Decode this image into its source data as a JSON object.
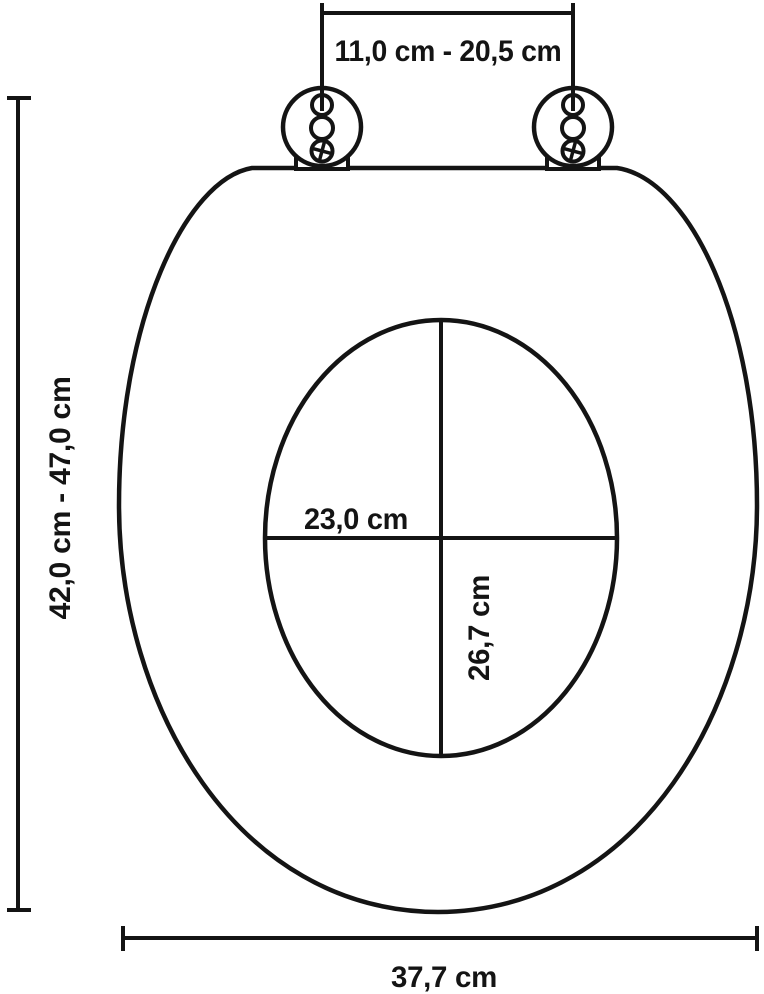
{
  "diagram": {
    "labels": {
      "hinge_spacing": "11,0 cm - 20,5 cm",
      "overall_length": "42,0 cm - 47,0 cm",
      "inner_width": "23,0 cm",
      "inner_depth": "26,7 cm",
      "overall_width": "37,7 cm"
    },
    "colors": {
      "line": "#141414",
      "background": "#ffffff"
    }
  }
}
